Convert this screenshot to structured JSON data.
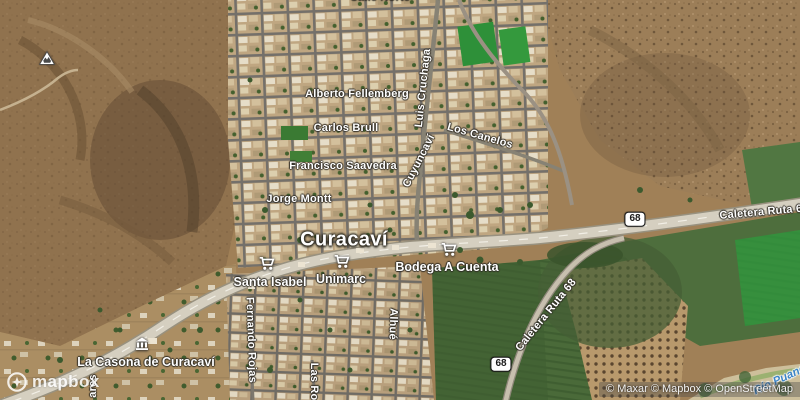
{
  "map": {
    "city": {
      "name": "Curacaví"
    },
    "streets": {
      "alberto_fellemberg": "Alberto Fellemberg",
      "carlos_brull": "Carlos Brull",
      "francisco_saavedra": "Francisco Saavedra",
      "jorge_montt": "Jorge Montt",
      "luis_cruchaga": "Luis Cruchaga",
      "cuyuncavi": "Cuyuncaví",
      "los_canelos": "Los Canelos",
      "fernando_rojas": "Fernando Rojas",
      "las_rosas": "Las Rosas",
      "alhue": "Alhué",
      "ares_partial": "ares",
      "norte_partial": "Calle Norte",
      "caletera_ruta_68_east": "Caletera Ruta 68",
      "caletera_ruta_68_south": "Caletera Ruta 68"
    },
    "pois": {
      "santa_isabel": {
        "name": "Santa Isabel",
        "icon": "shopping-cart"
      },
      "unimarc": {
        "name": "Unimarc",
        "icon": "shopping-cart"
      },
      "bodega_a_cuenta": {
        "name": "Bodega A Cuenta",
        "icon": "shopping-cart"
      },
      "la_casona": {
        "name": "La Casona de Curacaví",
        "icon": "museum"
      }
    },
    "route_shields": {
      "ruta68_a": "68",
      "ruta68_b": "68"
    },
    "river": {
      "name": "Río Puangue"
    },
    "branding": {
      "logo_text": "mapbox"
    },
    "attribution": {
      "text": "© Maxar © Mapbox © OpenStreetMap"
    },
    "colors": {
      "label_text": "#ffffff",
      "label_halo": "#2d2a23",
      "water_label": "#3d85c6",
      "shield_bg": "#ffffff",
      "shield_text": "#1a1a1a",
      "highway": "#d5cfc0",
      "farm_green": "#4e6e3d",
      "bright_field_green": "#2f9b3e",
      "hill_brown": "#8a6c49"
    }
  }
}
